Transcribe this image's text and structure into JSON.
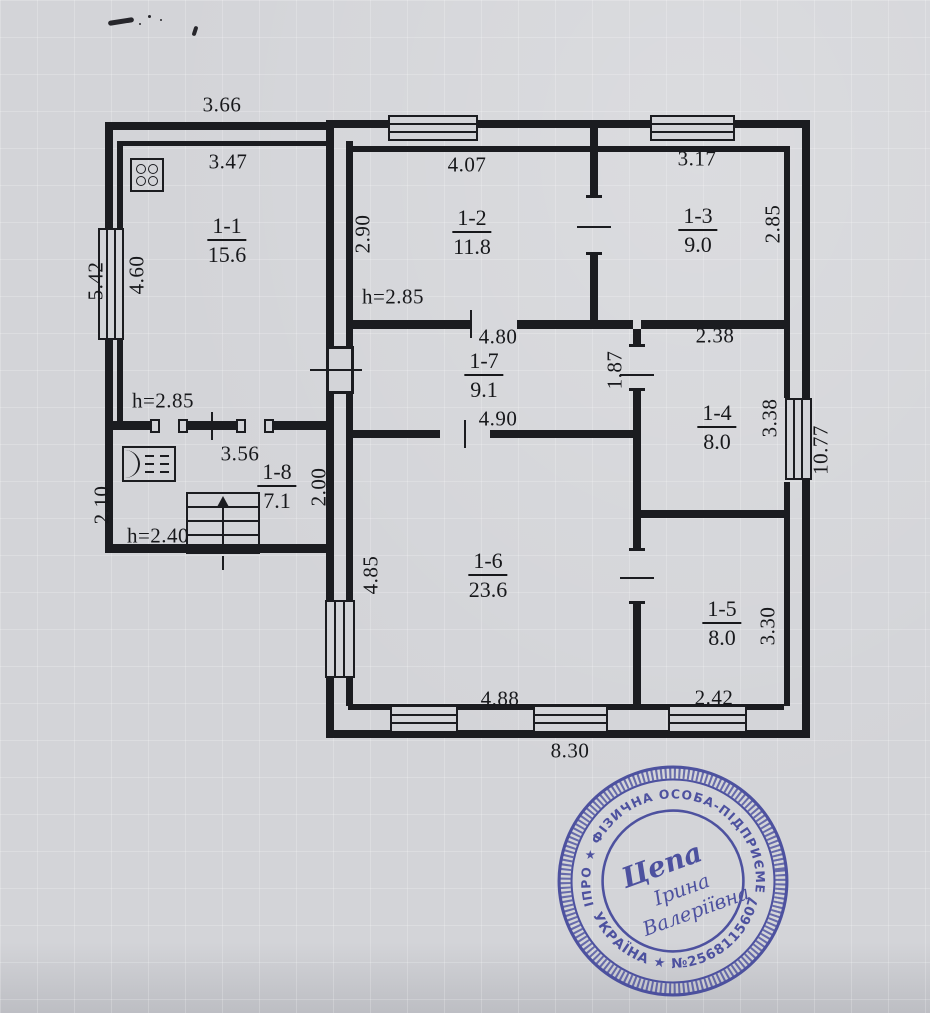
{
  "document": {
    "kind": "scanned floor plan sheet",
    "language": "uk"
  },
  "colors": {
    "paper": "#d3d4d8",
    "ink": "#1b1c20",
    "stamp_blue": "#3b4098"
  },
  "plan": {
    "rooms": [
      {
        "id": "1-1",
        "area": "15.6",
        "x": 227,
        "y": 214
      },
      {
        "id": "1-2",
        "area": "11.8",
        "x": 472,
        "y": 206
      },
      {
        "id": "1-3",
        "area": "9.0",
        "x": 698,
        "y": 204
      },
      {
        "id": "1-7",
        "area": "9.1",
        "x": 484,
        "y": 349
      },
      {
        "id": "1-4",
        "area": "8.0",
        "x": 717,
        "y": 401
      },
      {
        "id": "1-8",
        "area": "7.1",
        "x": 277,
        "y": 460
      },
      {
        "id": "1-6",
        "area": "23.6",
        "x": 488,
        "y": 549
      },
      {
        "id": "1-5",
        "area": "8.0",
        "x": 722,
        "y": 597
      }
    ],
    "dimensions": [
      {
        "text": "3.66",
        "x": 222,
        "y": 105,
        "rot": 0
      },
      {
        "text": "3.47",
        "x": 228,
        "y": 162,
        "rot": 0
      },
      {
        "text": "4.07",
        "x": 467,
        "y": 165,
        "rot": 0
      },
      {
        "text": "3.17",
        "x": 697,
        "y": 159,
        "rot": 0
      },
      {
        "text": "2.90",
        "x": 363,
        "y": 234,
        "rot": 1
      },
      {
        "text": "2.85",
        "x": 773,
        "y": 224,
        "rot": 1
      },
      {
        "text": "5.42",
        "x": 96,
        "y": 281,
        "rot": 1
      },
      {
        "text": "4.60",
        "x": 137,
        "y": 275,
        "rot": 1
      },
      {
        "text": "h=2.85",
        "x": 393,
        "y": 297,
        "rot": 0
      },
      {
        "text": "4.80",
        "x": 498,
        "y": 337,
        "rot": 0
      },
      {
        "text": "2.38",
        "x": 715,
        "y": 336,
        "rot": 0
      },
      {
        "text": "1.87",
        "x": 615,
        "y": 370,
        "rot": 1
      },
      {
        "text": "4.90",
        "x": 498,
        "y": 419,
        "rot": 0
      },
      {
        "text": "h=2.85",
        "x": 163,
        "y": 401,
        "rot": 0
      },
      {
        "text": "3.56",
        "x": 240,
        "y": 454,
        "rot": 0
      },
      {
        "text": "2.00",
        "x": 319,
        "y": 487,
        "rot": 1
      },
      {
        "text": "3.38",
        "x": 770,
        "y": 418,
        "rot": 1
      },
      {
        "text": "10.77",
        "x": 821,
        "y": 450,
        "rot": 1
      },
      {
        "text": "2.10",
        "x": 102,
        "y": 505,
        "rot": 1
      },
      {
        "text": "h=2.40",
        "x": 158,
        "y": 536,
        "rot": 0
      },
      {
        "text": "4.85",
        "x": 371,
        "y": 575,
        "rot": 1
      },
      {
        "text": "4.88",
        "x": 500,
        "y": 699,
        "rot": 0
      },
      {
        "text": "2.42",
        "x": 714,
        "y": 698,
        "rot": 0
      },
      {
        "text": "3.30",
        "x": 768,
        "y": 626,
        "rot": 1
      },
      {
        "text": "8.30",
        "x": 570,
        "y": 751,
        "rot": 0
      }
    ]
  },
  "stamp": {
    "ring_top": "м. ДНІПРО ★ ФІЗИЧНА ОСОБА-ПІДПРИЄМЕЦЬ ★",
    "ring_bottom": "УКРАЇНА ★ №2568115607",
    "name_line1": "Цепа",
    "name_line2": "Ірина",
    "name_line3": "Валеріївна"
  }
}
